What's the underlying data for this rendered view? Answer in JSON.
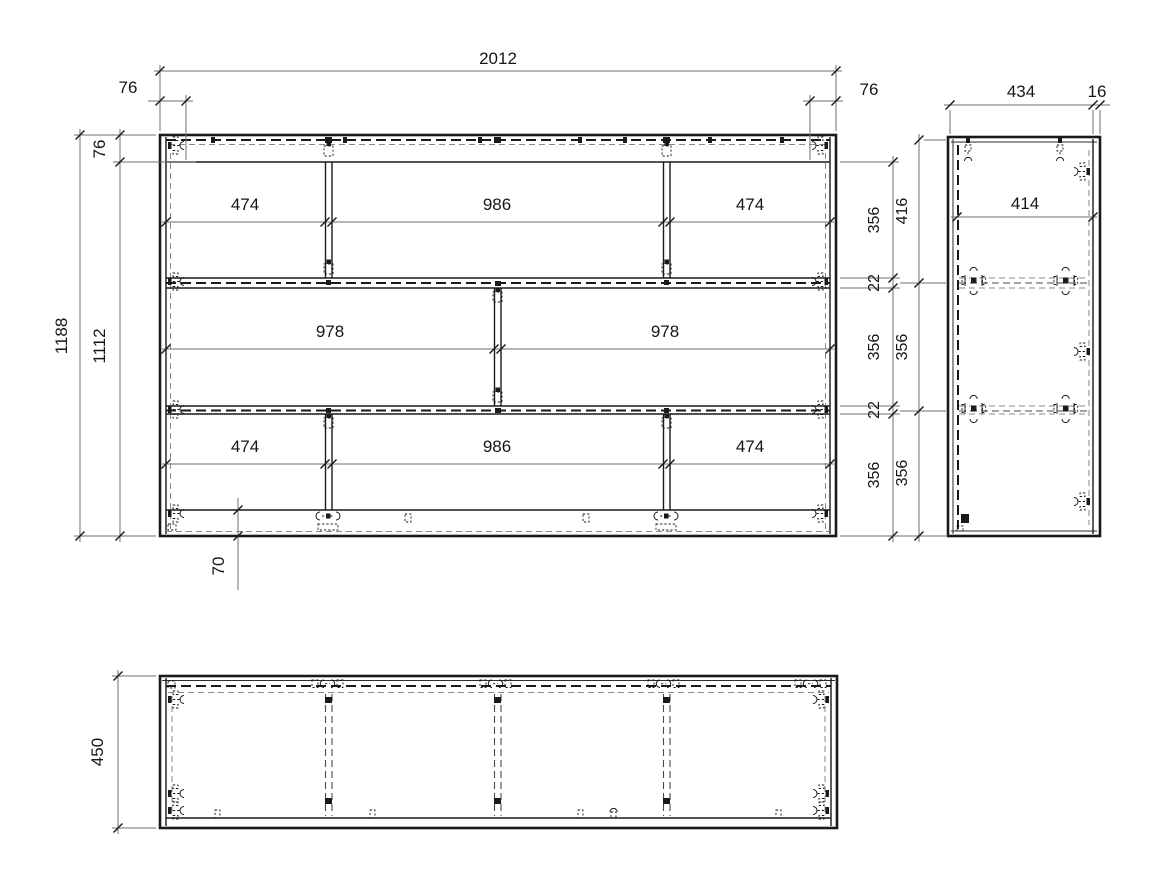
{
  "views": {
    "front": {
      "dim_total_width": "2012",
      "dim_offset_left": "76",
      "dim_offset_right": "76",
      "dim_total_height": "1188",
      "dim_inner_height": "1112",
      "dim_top_rail": "76",
      "dim_plinth": "70",
      "row1": [
        "474",
        "986",
        "474"
      ],
      "row2": [
        "978",
        "978"
      ],
      "row3": [
        "474",
        "986",
        "474"
      ],
      "right_chain": [
        "356",
        "22",
        "356",
        "22",
        "356"
      ]
    },
    "side": {
      "dim_depth": "434",
      "dim_back_panel": "16",
      "dim_inner_depth": "414",
      "chain": [
        "416",
        "356",
        "356"
      ]
    },
    "top": {
      "dim_depth": "450"
    }
  }
}
